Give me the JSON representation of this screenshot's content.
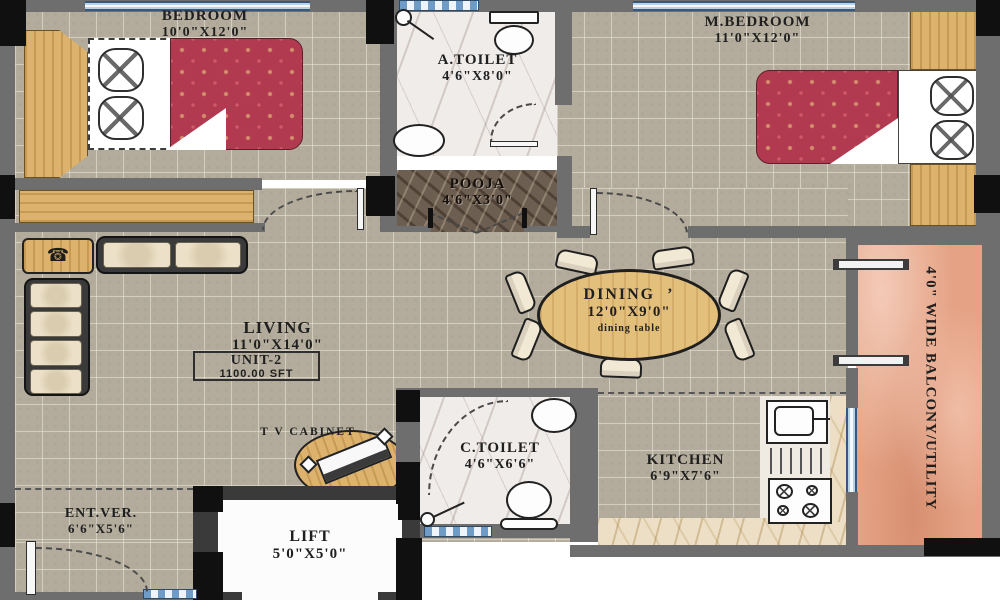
{
  "rooms": {
    "bedroom": {
      "name": "BEDROOM",
      "dims": "10'0\"X12'0\""
    },
    "a_toilet": {
      "name": "A.TOILET",
      "dims": "4'6\"X8'0\""
    },
    "m_bedroom": {
      "name": "M.BEDROOM",
      "dims": "11'0\"X12'0\""
    },
    "pooja": {
      "name": "POOJA",
      "dims": "4'6\"X3'0\""
    },
    "living": {
      "name": "LIVING",
      "dims": "11'0\"X14'0\""
    },
    "dining": {
      "name": "DINING",
      "mark": "’",
      "dims": "12'0\"X9'0\"",
      "note": "dining  table"
    },
    "kitchen": {
      "name": "KITCHEN",
      "dims": "6'9\"X7'6\""
    },
    "c_toilet": {
      "name": "C.TOILET",
      "dims": "4'6\"X6'6\""
    },
    "ent_ver": {
      "name": "ENT.VER.",
      "dims": "6'6\"X5'6\""
    },
    "lift": {
      "name": "LIFT",
      "dims": "5'0\"X5'0\""
    },
    "balcony": {
      "name": "4'0\"  WIDE  BALCONY/UTILITY"
    }
  },
  "unit": {
    "label": "UNIT-2",
    "area": "1100.00 SFT"
  },
  "tv_cabinet_label": "T V CABINET",
  "colors": {
    "wall": "#6e6e6e",
    "corner_block": "#101010",
    "floor_tile": "#b3ac9c",
    "wood": "#dcb26c",
    "bed_red": "#b13a50",
    "balcony_pink": "#e5a284",
    "pooja_marble": "#6c5e50",
    "toilet_marble": "#efecea",
    "counter_beige": "#ecdfc5",
    "window_blue": "#6f9cc6"
  }
}
